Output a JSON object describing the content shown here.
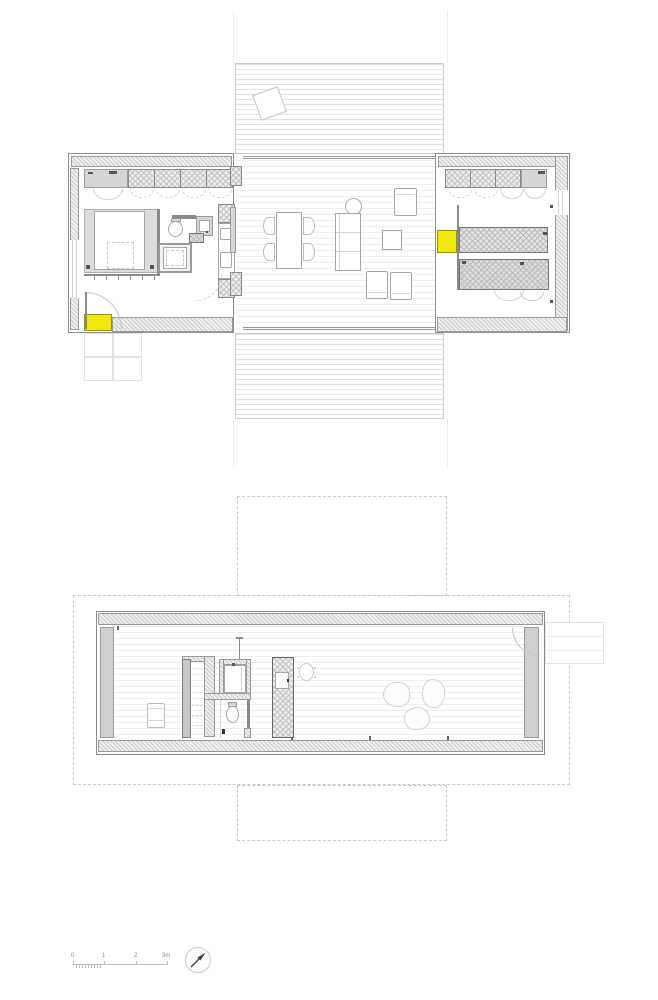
{
  "document": {
    "type": "architectural-floor-plans",
    "sheets": [
      "upper floor plan with terraces",
      "lower floor plan with footprint overlay"
    ]
  },
  "scale_bar": {
    "labels": [
      "0",
      "1",
      "2",
      "3m"
    ],
    "unit": "m"
  },
  "north_arrow": {
    "direction": "north-east"
  },
  "colors": {
    "accent_yellow": "#f0e80a",
    "wall_fill": "#d4d4d4",
    "hatch_line": "#c8c8c8",
    "outline": "#8a8a8a",
    "plank_line": "#e2e2e2",
    "paper": "#ffffff"
  },
  "plans": {
    "upper": {
      "name": "main-floor-plan",
      "zones": [
        "terrace-deck-top",
        "bedroom-wing-left",
        "living-dining-center",
        "kitchen-wing-right",
        "terrace-deck-bottom"
      ],
      "furniture": [
        "bed",
        "wardrobes",
        "toilet",
        "washbasin",
        "shower",
        "dining-table",
        "chairs",
        "sofa",
        "side-table",
        "armchair",
        "coffee-table",
        "kitchen-counters",
        "desk"
      ],
      "highlights": [
        "entry-mat-yellow",
        "kitchen-unit-yellow"
      ]
    },
    "lower": {
      "name": "lower-floor-plan",
      "zones": [
        "open-room",
        "bathroom-core",
        "entry-door",
        "exterior-stair"
      ],
      "furniture": [
        "lounge-chair",
        "toilet",
        "shower",
        "round-chair",
        "beanbag-seats"
      ],
      "overlay": "dashed-outline-of-upper-floor-footprint"
    }
  }
}
